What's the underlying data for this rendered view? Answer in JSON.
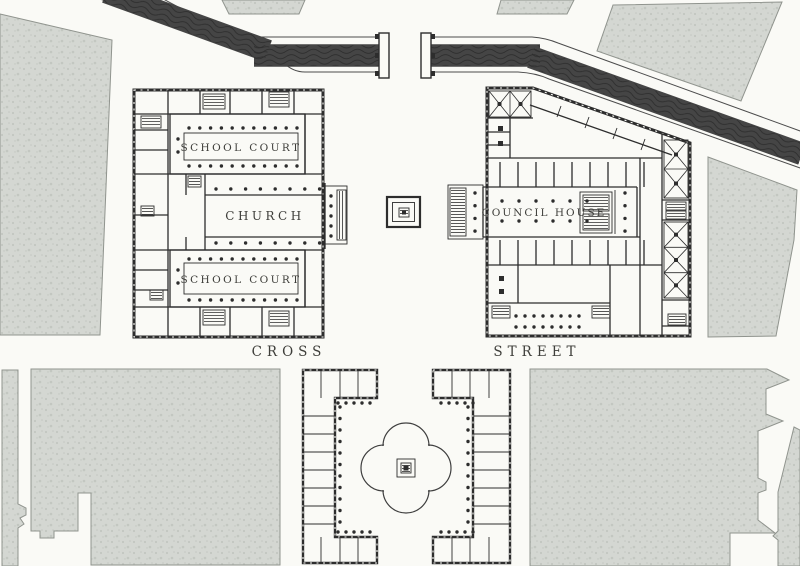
{
  "labels": {
    "school_court_top": "SCHOOL COURT",
    "church": "CHURCH",
    "school_court_bottom": "SCHOOL COURT",
    "council_house": "COUNCIL HOUSE",
    "street_word_left": "CROSS",
    "street_word_right": "STREET"
  },
  "features": {
    "water": "canal-wave-hatching",
    "blocks": "stippled-city-blocks",
    "monument": "square-market-cross",
    "pool": "quatrefoil-pool"
  },
  "colors": {
    "paper": "#fafaf6",
    "ink": "#2d2d2d",
    "bank": "#4c4c4c",
    "text": "#3e3e3a",
    "gray_fill": "#d4d7d2",
    "gray_speck": "#c3c7c1",
    "gray_edge": "#90948e"
  }
}
